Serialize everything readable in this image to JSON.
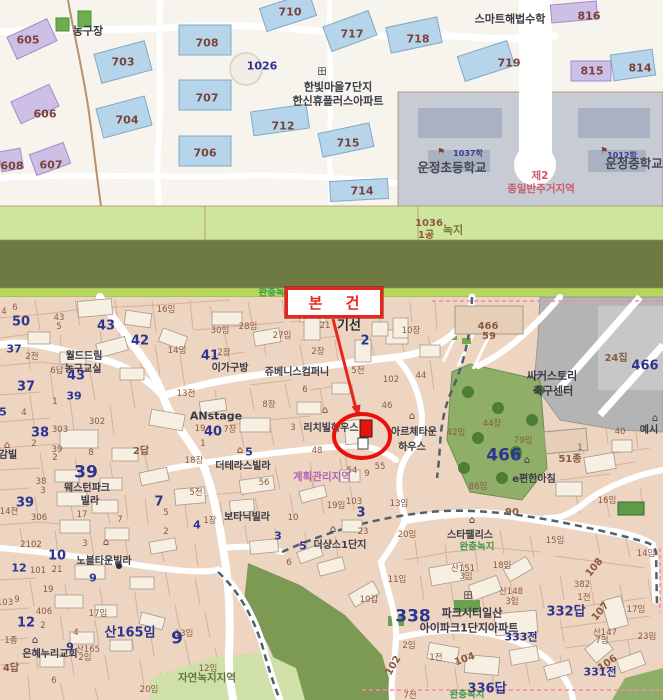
{
  "annotation": {
    "subject_label": "본 건"
  },
  "colors": {
    "annotation_red": "#e8251d",
    "parcel_number_blue": "#2c3590",
    "lot_label_brown": "#8a5a40",
    "zone_purple": "#b266b2",
    "zone_red": "#cc5b6e",
    "zone_green": "#3d9a4d",
    "park_green": "#8fae67",
    "school_gray": "#c6cbd4",
    "map_tan": "#edd5c2",
    "buffer_olive": "#6d7a41",
    "greenbelt_light": "#cfe49c"
  },
  "map_labels": [
    {
      "t": "605",
      "x": 28,
      "y": 40,
      "c": "apt"
    },
    {
      "t": "606",
      "x": 45,
      "y": 114,
      "c": "apt"
    },
    {
      "t": "607",
      "x": 51,
      "y": 165,
      "c": "apt"
    },
    {
      "t": "608",
      "x": 12,
      "y": 166,
      "c": "apt"
    },
    {
      "t": "703",
      "x": 123,
      "y": 62,
      "c": "apt"
    },
    {
      "t": "704",
      "x": 127,
      "y": 120,
      "c": "apt"
    },
    {
      "t": "706",
      "x": 205,
      "y": 153,
      "c": "apt"
    },
    {
      "t": "707",
      "x": 207,
      "y": 98,
      "c": "apt"
    },
    {
      "t": "708",
      "x": 207,
      "y": 43,
      "c": "apt"
    },
    {
      "t": "710",
      "x": 290,
      "y": 12,
      "c": "apt"
    },
    {
      "t": "712",
      "x": 283,
      "y": 126,
      "c": "apt"
    },
    {
      "t": "714",
      "x": 362,
      "y": 191,
      "c": "apt"
    },
    {
      "t": "715",
      "x": 348,
      "y": 143,
      "c": "apt"
    },
    {
      "t": "717",
      "x": 352,
      "y": 34,
      "c": "apt"
    },
    {
      "t": "718",
      "x": 418,
      "y": 39,
      "c": "apt"
    },
    {
      "t": "719",
      "x": 509,
      "y": 63,
      "c": "apt"
    },
    {
      "t": "814",
      "x": 640,
      "y": 68,
      "c": "apt"
    },
    {
      "t": "815",
      "x": 592,
      "y": 71,
      "c": "apt"
    },
    {
      "t": "816",
      "x": 589,
      "y": 16,
      "c": "apt"
    },
    {
      "t": "1026",
      "x": 262,
      "y": 66,
      "c": "blue-md"
    },
    {
      "t": "농구장",
      "x": 88,
      "y": 31,
      "c": "name-md"
    },
    {
      "t": "스마트해법수학",
      "x": 510,
      "y": 19,
      "c": "name-md"
    },
    {
      "t": "한빛마을7단지",
      "x": 338,
      "y": 87,
      "c": "name-md"
    },
    {
      "t": "한신휴플러스아파트",
      "x": 338,
      "y": 101,
      "c": "name-md"
    },
    {
      "t": "田",
      "x": 322,
      "y": 73,
      "c": "icon-grid",
      "n": "apartment-complex-icon"
    },
    {
      "t": "운정초등학교",
      "x": 452,
      "y": 168,
      "c": "name-lg"
    },
    {
      "t": "⚑",
      "x": 441,
      "y": 153,
      "c": "icon-flag",
      "n": "school-flag-icon"
    },
    {
      "t": "1037학",
      "x": 468,
      "y": 154,
      "c": "sch-sm"
    },
    {
      "t": "운정중학교",
      "x": 634,
      "y": 164,
      "c": "name-lg"
    },
    {
      "t": "⚑",
      "x": 604,
      "y": 152,
      "c": "icon-flag",
      "n": "school-flag-icon"
    },
    {
      "t": "1012학",
      "x": 622,
      "y": 156,
      "c": "sch-sm"
    },
    {
      "t": "제2",
      "x": 540,
      "y": 176,
      "c": "zone-red"
    },
    {
      "t": "종일반주거지역",
      "x": 541,
      "y": 189,
      "c": "zone-red"
    },
    {
      "t": "1036",
      "x": 429,
      "y": 224,
      "c": "brown-md"
    },
    {
      "t": "1공",
      "x": 426,
      "y": 236,
      "c": "brown-md"
    },
    {
      "t": "녹지",
      "x": 453,
      "y": 230,
      "c": "olive-md"
    },
    {
      "t": "완충녹지",
      "x": 276,
      "y": 293,
      "c": "zone-green"
    },
    {
      "t": "4",
      "x": 4,
      "y": 312,
      "c": "brown-sm"
    },
    {
      "t": "6",
      "x": 15,
      "y": 308,
      "c": "brown-sm"
    },
    {
      "t": "50",
      "x": 21,
      "y": 322,
      "c": "blue-lg"
    },
    {
      "t": "43",
      "x": 59,
      "y": 318,
      "c": "brown-sm"
    },
    {
      "t": "5",
      "x": 59,
      "y": 327,
      "c": "brown-sm"
    },
    {
      "t": "43",
      "x": 106,
      "y": 326,
      "c": "blue-lg"
    },
    {
      "t": "42",
      "x": 140,
      "y": 341,
      "c": "blue-lg"
    },
    {
      "t": "37",
      "x": 14,
      "y": 349,
      "c": "blue-md"
    },
    {
      "t": "2전",
      "x": 32,
      "y": 357,
      "c": "brown-sm"
    },
    {
      "t": "월드드림",
      "x": 84,
      "y": 357,
      "c": "name"
    },
    {
      "t": "농구교실",
      "x": 83,
      "y": 370,
      "c": "name"
    },
    {
      "t": "6답",
      "x": 57,
      "y": 371,
      "c": "brown-sm"
    },
    {
      "t": "43",
      "x": 76,
      "y": 376,
      "c": "blue-lg"
    },
    {
      "t": "37",
      "x": 26,
      "y": 387,
      "c": "blue-lg"
    },
    {
      "t": "39",
      "x": 74,
      "y": 396,
      "c": "blue-md"
    },
    {
      "t": "1",
      "x": 55,
      "y": 402,
      "c": "brown-sm"
    },
    {
      "t": "4",
      "x": 24,
      "y": 413,
      "c": "brown-sm"
    },
    {
      "t": "5",
      "x": 3,
      "y": 412,
      "c": "blue-md"
    },
    {
      "t": "16임",
      "x": 166,
      "y": 310,
      "c": "brown-sm"
    },
    {
      "t": "14임",
      "x": 177,
      "y": 351,
      "c": "brown-sm"
    },
    {
      "t": "30임",
      "x": 220,
      "y": 331,
      "c": "brown-sm"
    },
    {
      "t": "28임",
      "x": 248,
      "y": 327,
      "c": "brown-sm"
    },
    {
      "t": "27임",
      "x": 282,
      "y": 336,
      "c": "brown-sm"
    },
    {
      "t": "41",
      "x": 210,
      "y": 356,
      "c": "blue-lg"
    },
    {
      "t": "2장",
      "x": 224,
      "y": 353,
      "c": "brown-sm"
    },
    {
      "t": "이가구방",
      "x": 230,
      "y": 369,
      "c": "name"
    },
    {
      "t": "쥬베니스컴퍼니",
      "x": 297,
      "y": 373,
      "c": "name"
    },
    {
      "t": "13전",
      "x": 186,
      "y": 394,
      "c": "brown-sm"
    },
    {
      "t": "8장",
      "x": 269,
      "y": 405,
      "c": "brown-sm"
    },
    {
      "t": "ANstage",
      "x": 216,
      "y": 416,
      "c": "name-md"
    },
    {
      "t": "19",
      "x": 200,
      "y": 429,
      "c": "brown-sm"
    },
    {
      "t": "40",
      "x": 213,
      "y": 432,
      "c": "blue-lg"
    },
    {
      "t": "7장",
      "x": 230,
      "y": 430,
      "c": "brown-sm"
    },
    {
      "t": "⌂",
      "x": 325,
      "y": 411,
      "c": "icon-red",
      "n": "house-icon"
    },
    {
      "t": "3",
      "x": 293,
      "y": 428,
      "c": "brown-sm"
    },
    {
      "t": "리치빌하우스",
      "x": 331,
      "y": 429,
      "c": "name"
    },
    {
      "t": "21",
      "x": 325,
      "y": 326,
      "c": "brown-sm"
    },
    {
      "t": "기선",
      "x": 349,
      "y": 326,
      "c": "name-xl"
    },
    {
      "t": "2",
      "x": 365,
      "y": 341,
      "c": "blue-lg"
    },
    {
      "t": "10장",
      "x": 411,
      "y": 331,
      "c": "brown-sm"
    },
    {
      "t": "2장",
      "x": 318,
      "y": 352,
      "c": "brown-sm"
    },
    {
      "t": "5전",
      "x": 358,
      "y": 371,
      "c": "brown-sm"
    },
    {
      "t": "44",
      "x": 421,
      "y": 376,
      "c": "brown-sm"
    },
    {
      "t": "102",
      "x": 391,
      "y": 380,
      "c": "brown-sm"
    },
    {
      "t": "6",
      "x": 305,
      "y": 390,
      "c": "brown-sm"
    },
    {
      "t": "46",
      "x": 387,
      "y": 406,
      "c": "brown-sm"
    },
    {
      "t": "⌂",
      "x": 412,
      "y": 417,
      "c": "icon-red",
      "n": "house-icon"
    },
    {
      "t": "아르체타운",
      "x": 414,
      "y": 433,
      "c": "name"
    },
    {
      "t": "하우스",
      "x": 412,
      "y": 448,
      "c": "name"
    },
    {
      "t": "42임",
      "x": 456,
      "y": 433,
      "c": "brown-sm"
    },
    {
      "t": "44장",
      "x": 492,
      "y": 424,
      "c": "brown-sm"
    },
    {
      "t": "79임",
      "x": 523,
      "y": 441,
      "c": "brown-sm"
    },
    {
      "t": "51종",
      "x": 570,
      "y": 460,
      "c": "brown-md"
    },
    {
      "t": "⌂",
      "x": 527,
      "y": 461,
      "c": "icon-dark",
      "n": "house-icon"
    },
    {
      "t": "e편한아침",
      "x": 534,
      "y": 480,
      "c": "name"
    },
    {
      "t": "86임",
      "x": 478,
      "y": 487,
      "c": "brown-sm"
    },
    {
      "t": "466",
      "x": 488,
      "y": 327,
      "c": "brown-md"
    },
    {
      "t": "59",
      "x": 489,
      "y": 337,
      "c": "brown-md"
    },
    {
      "t": "24집",
      "x": 616,
      "y": 359,
      "c": "brown-md"
    },
    {
      "t": "466",
      "x": 645,
      "y": 366,
      "c": "blue-lg"
    },
    {
      "t": "싸커스토리",
      "x": 552,
      "y": 376,
      "c": "name-md"
    },
    {
      "t": "축구센터",
      "x": 553,
      "y": 391,
      "c": "name-md"
    },
    {
      "t": "466",
      "x": 504,
      "y": 456,
      "c": "blue-xl"
    },
    {
      "t": "40",
      "x": 620,
      "y": 432,
      "c": "brown-sm"
    },
    {
      "t": "1",
      "x": 580,
      "y": 448,
      "c": "brown-sm"
    },
    {
      "t": "⌂",
      "x": 655,
      "y": 419,
      "c": "icon-dark",
      "n": "house-icon"
    },
    {
      "t": "예시",
      "x": 649,
      "y": 431,
      "c": "name"
    },
    {
      "t": "48",
      "x": 317,
      "y": 451,
      "c": "brown-sm"
    },
    {
      "t": "55",
      "x": 380,
      "y": 467,
      "c": "brown-sm"
    },
    {
      "t": "54",
      "x": 352,
      "y": 471,
      "c": "brown-sm"
    },
    {
      "t": "9",
      "x": 367,
      "y": 474,
      "c": "brown-sm"
    },
    {
      "t": "계획관리지역",
      "x": 322,
      "y": 477,
      "c": "zone-purple"
    },
    {
      "t": "56",
      "x": 264,
      "y": 483,
      "c": "brown-sm"
    },
    {
      "t": "⌂",
      "x": 240,
      "y": 451,
      "c": "icon-red",
      "n": "house-icon"
    },
    {
      "t": "5",
      "x": 249,
      "y": 452,
      "c": "blue-md"
    },
    {
      "t": "더테라스빌라",
      "x": 243,
      "y": 467,
      "c": "name"
    },
    {
      "t": "18장",
      "x": 194,
      "y": 461,
      "c": "brown-sm"
    },
    {
      "t": "1",
      "x": 203,
      "y": 444,
      "c": "brown-sm"
    },
    {
      "t": "5전",
      "x": 196,
      "y": 493,
      "c": "brown-sm"
    },
    {
      "t": "7",
      "x": 159,
      "y": 502,
      "c": "blue-lg"
    },
    {
      "t": "5",
      "x": 166,
      "y": 513,
      "c": "brown-sm"
    },
    {
      "t": "2",
      "x": 166,
      "y": 532,
      "c": "brown-sm"
    },
    {
      "t": "4",
      "x": 197,
      "y": 525,
      "c": "blue-md"
    },
    {
      "t": "1장",
      "x": 210,
      "y": 521,
      "c": "brown-sm"
    },
    {
      "t": "보타닉빌라",
      "x": 247,
      "y": 518,
      "c": "name"
    },
    {
      "t": "10",
      "x": 293,
      "y": 518,
      "c": "brown-sm"
    },
    {
      "t": "3",
      "x": 278,
      "y": 536,
      "c": "blue-md"
    },
    {
      "t": "39",
      "x": 86,
      "y": 473,
      "c": "blue-xl"
    },
    {
      "t": "웨스턴파크",
      "x": 87,
      "y": 489,
      "c": "name"
    },
    {
      "t": "빌라",
      "x": 90,
      "y": 502,
      "c": "name"
    },
    {
      "t": "38",
      "x": 41,
      "y": 482,
      "c": "brown-sm"
    },
    {
      "t": "3",
      "x": 43,
      "y": 491,
      "c": "brown-sm"
    },
    {
      "t": "39",
      "x": 25,
      "y": 503,
      "c": "blue-lg"
    },
    {
      "t": "14전",
      "x": 9,
      "y": 512,
      "c": "brown-sm"
    },
    {
      "t": "306",
      "x": 39,
      "y": 518,
      "c": "brown-sm"
    },
    {
      "t": "17",
      "x": 82,
      "y": 515,
      "c": "brown-sm"
    },
    {
      "t": "7",
      "x": 120,
      "y": 520,
      "c": "brown-sm"
    },
    {
      "t": "302",
      "x": 97,
      "y": 422,
      "c": "brown-sm"
    },
    {
      "t": "303",
      "x": 60,
      "y": 430,
      "c": "brown-sm"
    },
    {
      "t": "38",
      "x": 40,
      "y": 433,
      "c": "blue-lg"
    },
    {
      "t": "2",
      "x": 34,
      "y": 444,
      "c": "brown-sm"
    },
    {
      "t": "39",
      "x": 57,
      "y": 450,
      "c": "brown-sm"
    },
    {
      "t": "2",
      "x": 55,
      "y": 458,
      "c": "brown-sm"
    },
    {
      "t": "8",
      "x": 91,
      "y": 453,
      "c": "brown-sm"
    },
    {
      "t": "2답",
      "x": 141,
      "y": 452,
      "c": "brown-md"
    },
    {
      "t": "⌂",
      "x": 7,
      "y": 446,
      "c": "icon-red",
      "n": "house-icon"
    },
    {
      "t": "감빌",
      "x": 8,
      "y": 456,
      "c": "name"
    },
    {
      "t": "2102",
      "x": 31,
      "y": 545,
      "c": "brown-sm"
    },
    {
      "t": "3",
      "x": 85,
      "y": 544,
      "c": "brown-sm"
    },
    {
      "t": "⌂",
      "x": 106,
      "y": 543,
      "c": "icon-red",
      "n": "house-icon"
    },
    {
      "t": "10",
      "x": 57,
      "y": 556,
      "c": "blue-lg"
    },
    {
      "t": "노블타운빌라",
      "x": 104,
      "y": 562,
      "c": "name"
    },
    {
      "t": "●",
      "x": 119,
      "y": 566,
      "c": "icon-dot",
      "n": "dot-icon"
    },
    {
      "t": "12",
      "x": 19,
      "y": 568,
      "c": "blue-md"
    },
    {
      "t": "101",
      "x": 38,
      "y": 571,
      "c": "brown-sm"
    },
    {
      "t": "21",
      "x": 57,
      "y": 570,
      "c": "brown-sm"
    },
    {
      "t": "9",
      "x": 93,
      "y": 578,
      "c": "blue-md"
    },
    {
      "t": "19",
      "x": 48,
      "y": 590,
      "c": "brown-sm"
    },
    {
      "t": "9",
      "x": 17,
      "y": 600,
      "c": "brown-sm"
    },
    {
      "t": "103",
      "x": 5,
      "y": 603,
      "c": "brown-sm"
    },
    {
      "t": "406",
      "x": 44,
      "y": 612,
      "c": "brown-sm"
    },
    {
      "t": "17임",
      "x": 98,
      "y": 614,
      "c": "brown-sm"
    },
    {
      "t": "12",
      "x": 26,
      "y": 623,
      "c": "blue-lg"
    },
    {
      "t": "2",
      "x": 43,
      "y": 626,
      "c": "brown-sm"
    },
    {
      "t": "4",
      "x": 76,
      "y": 633,
      "c": "brown-sm"
    },
    {
      "t": "1종",
      "x": 11,
      "y": 641,
      "c": "brown-sm"
    },
    {
      "t": "⌂",
      "x": 35,
      "y": 641,
      "c": "icon-dark",
      "n": "church-icon"
    },
    {
      "t": "9",
      "x": 70,
      "y": 647,
      "c": "blue-md"
    },
    {
      "t": "은혜누리교회",
      "x": 50,
      "y": 655,
      "c": "name"
    },
    {
      "t": "산165",
      "x": 88,
      "y": 650,
      "c": "brown-sm"
    },
    {
      "t": "2임",
      "x": 85,
      "y": 658,
      "c": "brown-sm"
    },
    {
      "t": "4답",
      "x": 11,
      "y": 669,
      "c": "brown-md"
    },
    {
      "t": "6",
      "x": 54,
      "y": 681,
      "c": "brown-sm"
    },
    {
      "t": "산165임",
      "x": 130,
      "y": 633,
      "c": "blue-lg"
    },
    {
      "t": "13임",
      "x": 184,
      "y": 634,
      "c": "brown-sm"
    },
    {
      "t": "9",
      "x": 177,
      "y": 639,
      "c": "blue-xl"
    },
    {
      "t": "12임",
      "x": 208,
      "y": 669,
      "c": "brown-sm"
    },
    {
      "t": "자연녹지지역",
      "x": 207,
      "y": 678,
      "c": "zone-olive"
    },
    {
      "t": "20임",
      "x": 149,
      "y": 690,
      "c": "brown-sm"
    },
    {
      "t": "⌂",
      "x": 333,
      "y": 530,
      "c": "icon-dark",
      "n": "house-icon"
    },
    {
      "t": "5",
      "x": 303,
      "y": 546,
      "c": "blue-md"
    },
    {
      "t": "더샹스1단지",
      "x": 340,
      "y": 546,
      "c": "name"
    },
    {
      "t": "23",
      "x": 363,
      "y": 532,
      "c": "brown-sm"
    },
    {
      "t": "6",
      "x": 289,
      "y": 563,
      "c": "brown-sm"
    },
    {
      "t": "19임",
      "x": 336,
      "y": 506,
      "c": "brown-sm"
    },
    {
      "t": "103",
      "x": 354,
      "y": 502,
      "c": "brown-sm"
    },
    {
      "t": "3",
      "x": 361,
      "y": 513,
      "c": "blue-lg"
    },
    {
      "t": "13임",
      "x": 399,
      "y": 504,
      "c": "brown-sm"
    },
    {
      "t": "20임",
      "x": 407,
      "y": 535,
      "c": "brown-sm"
    },
    {
      "t": "⌂",
      "x": 472,
      "y": 521,
      "c": "icon-dark",
      "n": "house-icon"
    },
    {
      "t": "스타팰리스",
      "x": 470,
      "y": 536,
      "c": "name"
    },
    {
      "t": "완충녹지",
      "x": 477,
      "y": 547,
      "c": "zone-green"
    },
    {
      "t": "산151",
      "x": 463,
      "y": 569,
      "c": "brown-sm"
    },
    {
      "t": "3임",
      "x": 466,
      "y": 577,
      "c": "brown-sm"
    },
    {
      "t": "18임",
      "x": 502,
      "y": 566,
      "c": "brown-sm"
    },
    {
      "t": "15임",
      "x": 555,
      "y": 541,
      "c": "brown-sm"
    },
    {
      "t": "14임",
      "x": 646,
      "y": 554,
      "c": "brown-sm"
    },
    {
      "t": "108",
      "x": 595,
      "y": 568,
      "c": "brown-md",
      "r": -50
    },
    {
      "t": "382",
      "x": 582,
      "y": 585,
      "c": "brown-sm"
    },
    {
      "t": "1전",
      "x": 584,
      "y": 598,
      "c": "brown-sm"
    },
    {
      "t": "산148",
      "x": 511,
      "y": 592,
      "c": "brown-sm"
    },
    {
      "t": "3임",
      "x": 512,
      "y": 602,
      "c": "brown-sm"
    },
    {
      "t": "332답",
      "x": 566,
      "y": 612,
      "c": "blue-lg"
    },
    {
      "t": "田",
      "x": 468,
      "y": 597,
      "c": "icon-grid",
      "n": "apartment-complex-icon"
    },
    {
      "t": "338",
      "x": 413,
      "y": 617,
      "c": "blue-xl"
    },
    {
      "t": "파크시티일산",
      "x": 472,
      "y": 613,
      "c": "name-md"
    },
    {
      "t": "아이파크1단지아파트",
      "x": 469,
      "y": 628,
      "c": "name-md"
    },
    {
      "t": "333전",
      "x": 521,
      "y": 637,
      "c": "blue-md"
    },
    {
      "t": "104",
      "x": 465,
      "y": 660,
      "c": "brown-md",
      "r": -20
    },
    {
      "t": "1전",
      "x": 436,
      "y": 658,
      "c": "brown-sm"
    },
    {
      "t": "102",
      "x": 394,
      "y": 666,
      "c": "brown-md",
      "r": -60
    },
    {
      "t": "2임",
      "x": 409,
      "y": 646,
      "c": "brown-sm"
    },
    {
      "t": "336답",
      "x": 487,
      "y": 689,
      "c": "blue-lg"
    },
    {
      "t": "완충녹지",
      "x": 467,
      "y": 695,
      "c": "zone-green"
    },
    {
      "t": "7전",
      "x": 410,
      "y": 696,
      "c": "brown-sm"
    },
    {
      "t": "107",
      "x": 601,
      "y": 612,
      "c": "brown-md",
      "r": -50
    },
    {
      "t": "17임",
      "x": 636,
      "y": 610,
      "c": "brown-sm"
    },
    {
      "t": "산147",
      "x": 605,
      "y": 633,
      "c": "brown-sm"
    },
    {
      "t": "7임",
      "x": 602,
      "y": 641,
      "c": "brown-sm"
    },
    {
      "t": "23임",
      "x": 647,
      "y": 637,
      "c": "brown-sm"
    },
    {
      "t": "106",
      "x": 608,
      "y": 664,
      "c": "brown-md",
      "r": -35
    },
    {
      "t": "331전",
      "x": 600,
      "y": 672,
      "c": "blue-md"
    },
    {
      "t": "10갑",
      "x": 369,
      "y": 600,
      "c": "brown-sm"
    },
    {
      "t": "11임",
      "x": 397,
      "y": 580,
      "c": "brown-sm"
    },
    {
      "t": "16임",
      "x": 607,
      "y": 501,
      "c": "brown-sm"
    },
    {
      "t": "90",
      "x": 512,
      "y": 513,
      "c": "brown-md"
    }
  ]
}
